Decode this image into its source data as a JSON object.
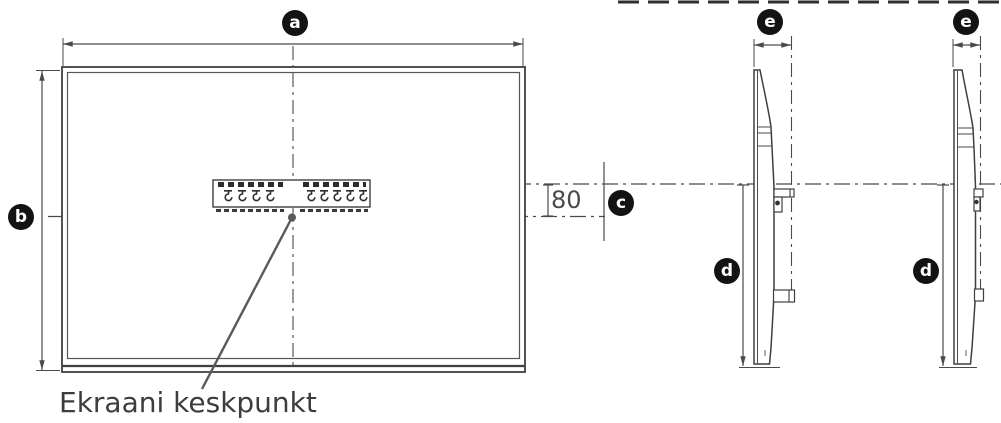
{
  "callouts": {
    "a": "a",
    "b": "b",
    "c": "c",
    "d": "d",
    "e": "e"
  },
  "labels": {
    "center_offset_mm": "80",
    "screen_center_caption": "Ekraani keskpunkt"
  },
  "colors": {
    "background": "#ffffff",
    "line": "#4a4a4a",
    "badge_background": "#131313",
    "badge_letter": "#ffffff",
    "caption_text": "#3d3d3d"
  }
}
